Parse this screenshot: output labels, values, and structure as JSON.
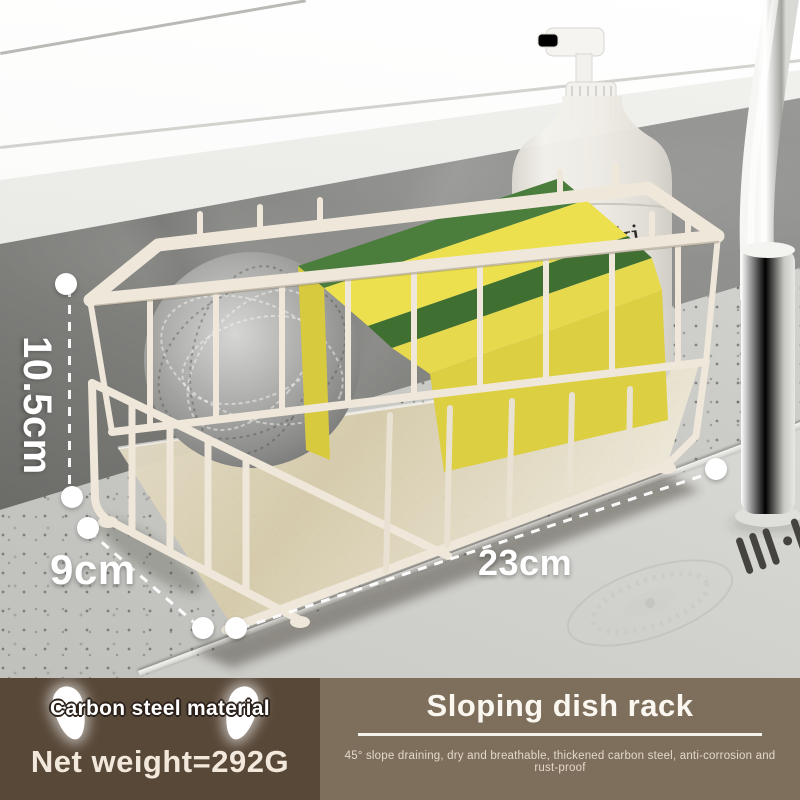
{
  "product_photo": {
    "bottle": {
      "brand": "meraki",
      "variant": "linen dew",
      "type": "BODY LOTION",
      "volume": "300 ml"
    },
    "dimensions": {
      "height": "10.5cm",
      "depth": "9cm",
      "width": "23cm"
    }
  },
  "banner": {
    "left": {
      "badge": "Carbon steel material",
      "weight": "Net weight=292G"
    },
    "right": {
      "title": "Sloping dish rack",
      "subtitle": "45° slope draining, dry and breathable, thickened carbon steel, anti-corrosion and rust-proof"
    }
  },
  "colors": {
    "banner_left_bg": "#584838",
    "banner_right_bg": "#7e6e5c",
    "rack_cream": "#efe8da",
    "sponge_yellow": "#e0d154",
    "sponge_green": "#4b7d3c",
    "scrubber_steel": "#9a9a98",
    "annotation_white": "#ffffff"
  }
}
